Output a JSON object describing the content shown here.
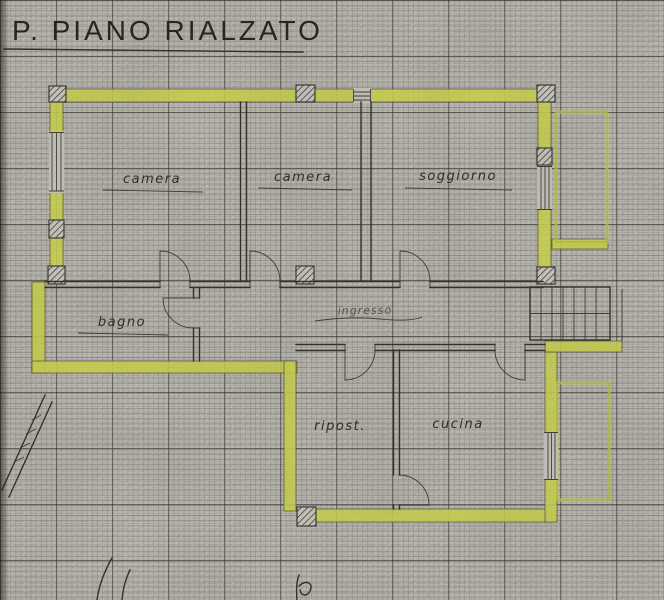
{
  "title": "P. PIANO RIALZATO",
  "floorplan": {
    "rooms": [
      {
        "name": "camera-1",
        "label": "camera"
      },
      {
        "name": "camera-2",
        "label": "camera"
      },
      {
        "name": "soggiorno",
        "label": "soggiorno"
      },
      {
        "name": "bagno",
        "label": "bagno"
      },
      {
        "name": "ingresso",
        "label": "ingresso"
      },
      {
        "name": "ripostiglio",
        "label": "ripost."
      },
      {
        "name": "cucina",
        "label": "cucina"
      }
    ],
    "colors": {
      "wall_highlight": "#d6de4c",
      "ink": "#2b2a24",
      "paper": "#c6c4be"
    }
  }
}
